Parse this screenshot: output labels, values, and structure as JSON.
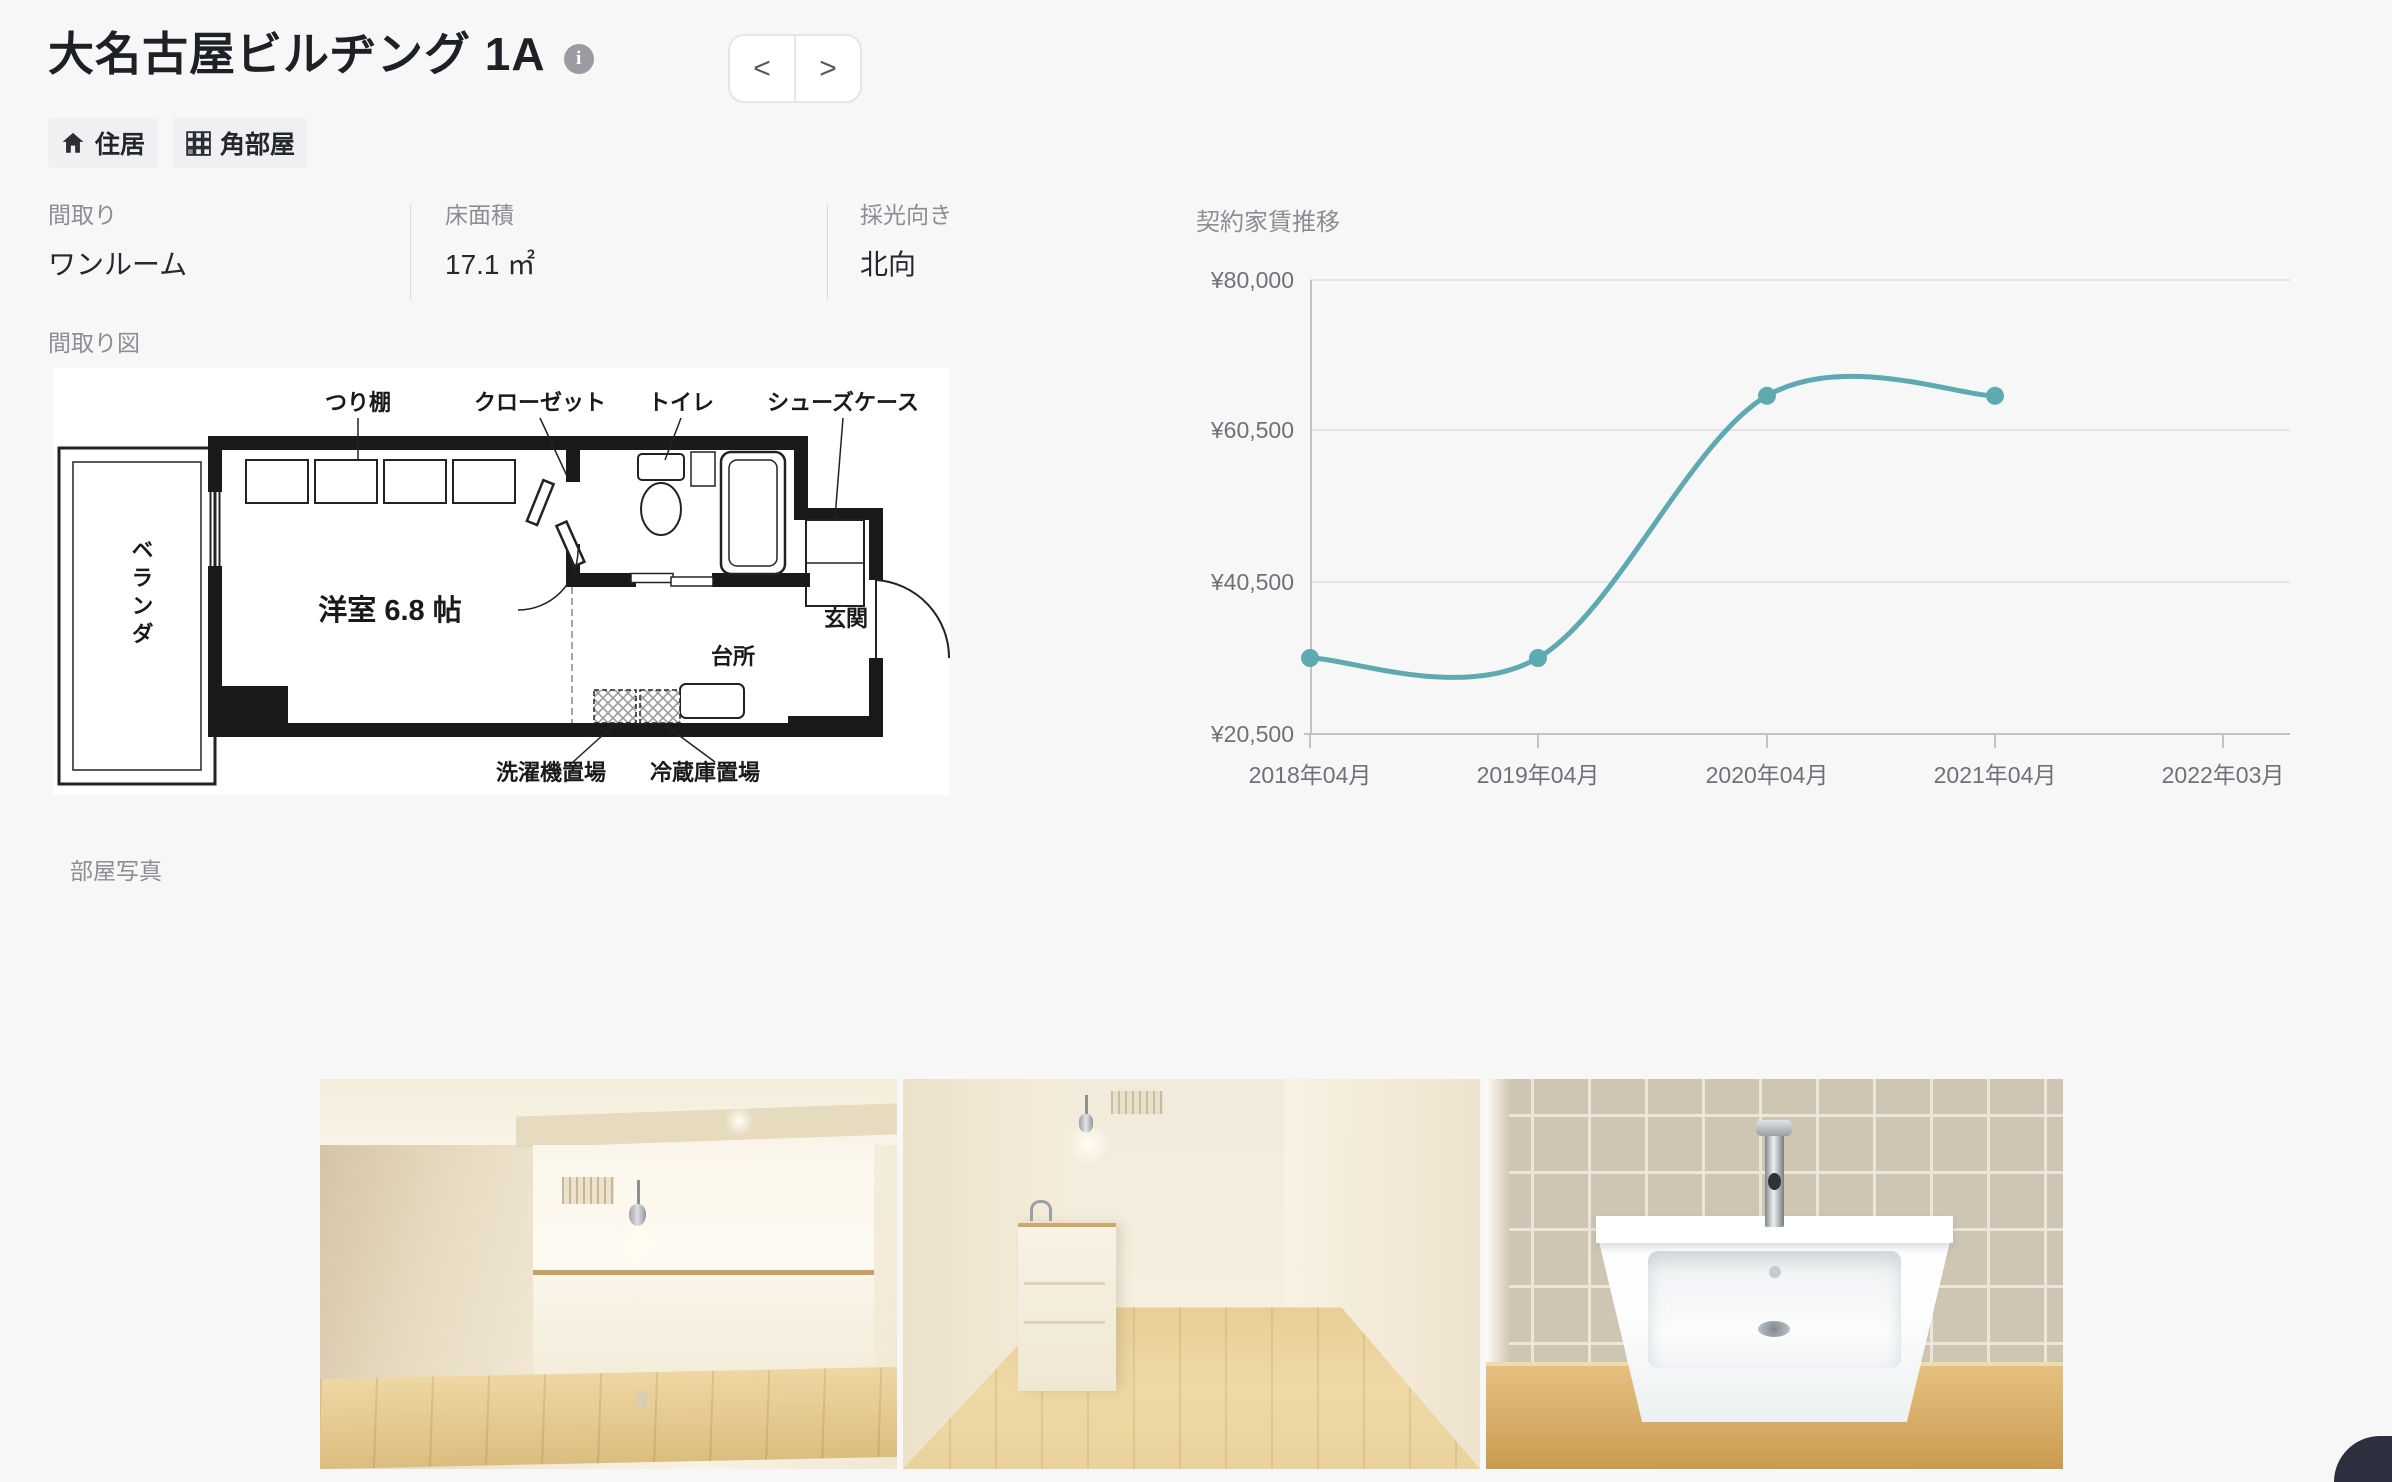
{
  "page": {
    "bg_color": "#f7f7f8"
  },
  "header": {
    "title": "大名古屋ビルヂング 1A",
    "info_icon_glyph": "i",
    "nav": {
      "prev": "<",
      "next": ">"
    },
    "tags": [
      {
        "icon": "home-icon",
        "label": "住居"
      },
      {
        "icon": "corner-grid-icon",
        "label": "角部屋"
      }
    ]
  },
  "details": [
    {
      "label": "間取り",
      "value": "ワンルーム"
    },
    {
      "label": "床面積",
      "value": "17.1 ㎡"
    },
    {
      "label": "採光向き",
      "value": "北向"
    }
  ],
  "floorplan": {
    "section_label": "間取り図",
    "labels": {
      "hanging_shelf": "つり棚",
      "closet": "クローゼット",
      "toilet": "トイレ",
      "shoe_case": "シューズケース",
      "veranda": "ベランダ",
      "room": "洋室 6.8 帖",
      "entrance": "玄関",
      "kitchen": "台所",
      "washer": "洗濯機置場",
      "fridge": "冷蔵庫置場"
    }
  },
  "chart_data": {
    "type": "line",
    "title": "契約家賃推移",
    "x": [
      "2018年04月",
      "2019年04月",
      "2020年04月",
      "2021年04月",
      "2022年03月"
    ],
    "series": [
      {
        "name": "契約家賃",
        "values": [
          30500,
          30500,
          65000,
          65000,
          null
        ]
      }
    ],
    "y_ticks": [
      {
        "label": "¥80,000",
        "value": 80000
      },
      {
        "label": "¥60,500",
        "value": 60500
      },
      {
        "label": "¥40,500",
        "value": 40500
      },
      {
        "label": "¥20,500",
        "value": 20500
      }
    ],
    "ylim": [
      20500,
      80000
    ],
    "line_color": "#5fa9b1",
    "grid": true,
    "legend": false
  },
  "photos": {
    "section_label": "部屋写真",
    "items": [
      {
        "name": "room-photo"
      },
      {
        "name": "hallway-photo"
      },
      {
        "name": "sink-photo"
      }
    ]
  }
}
